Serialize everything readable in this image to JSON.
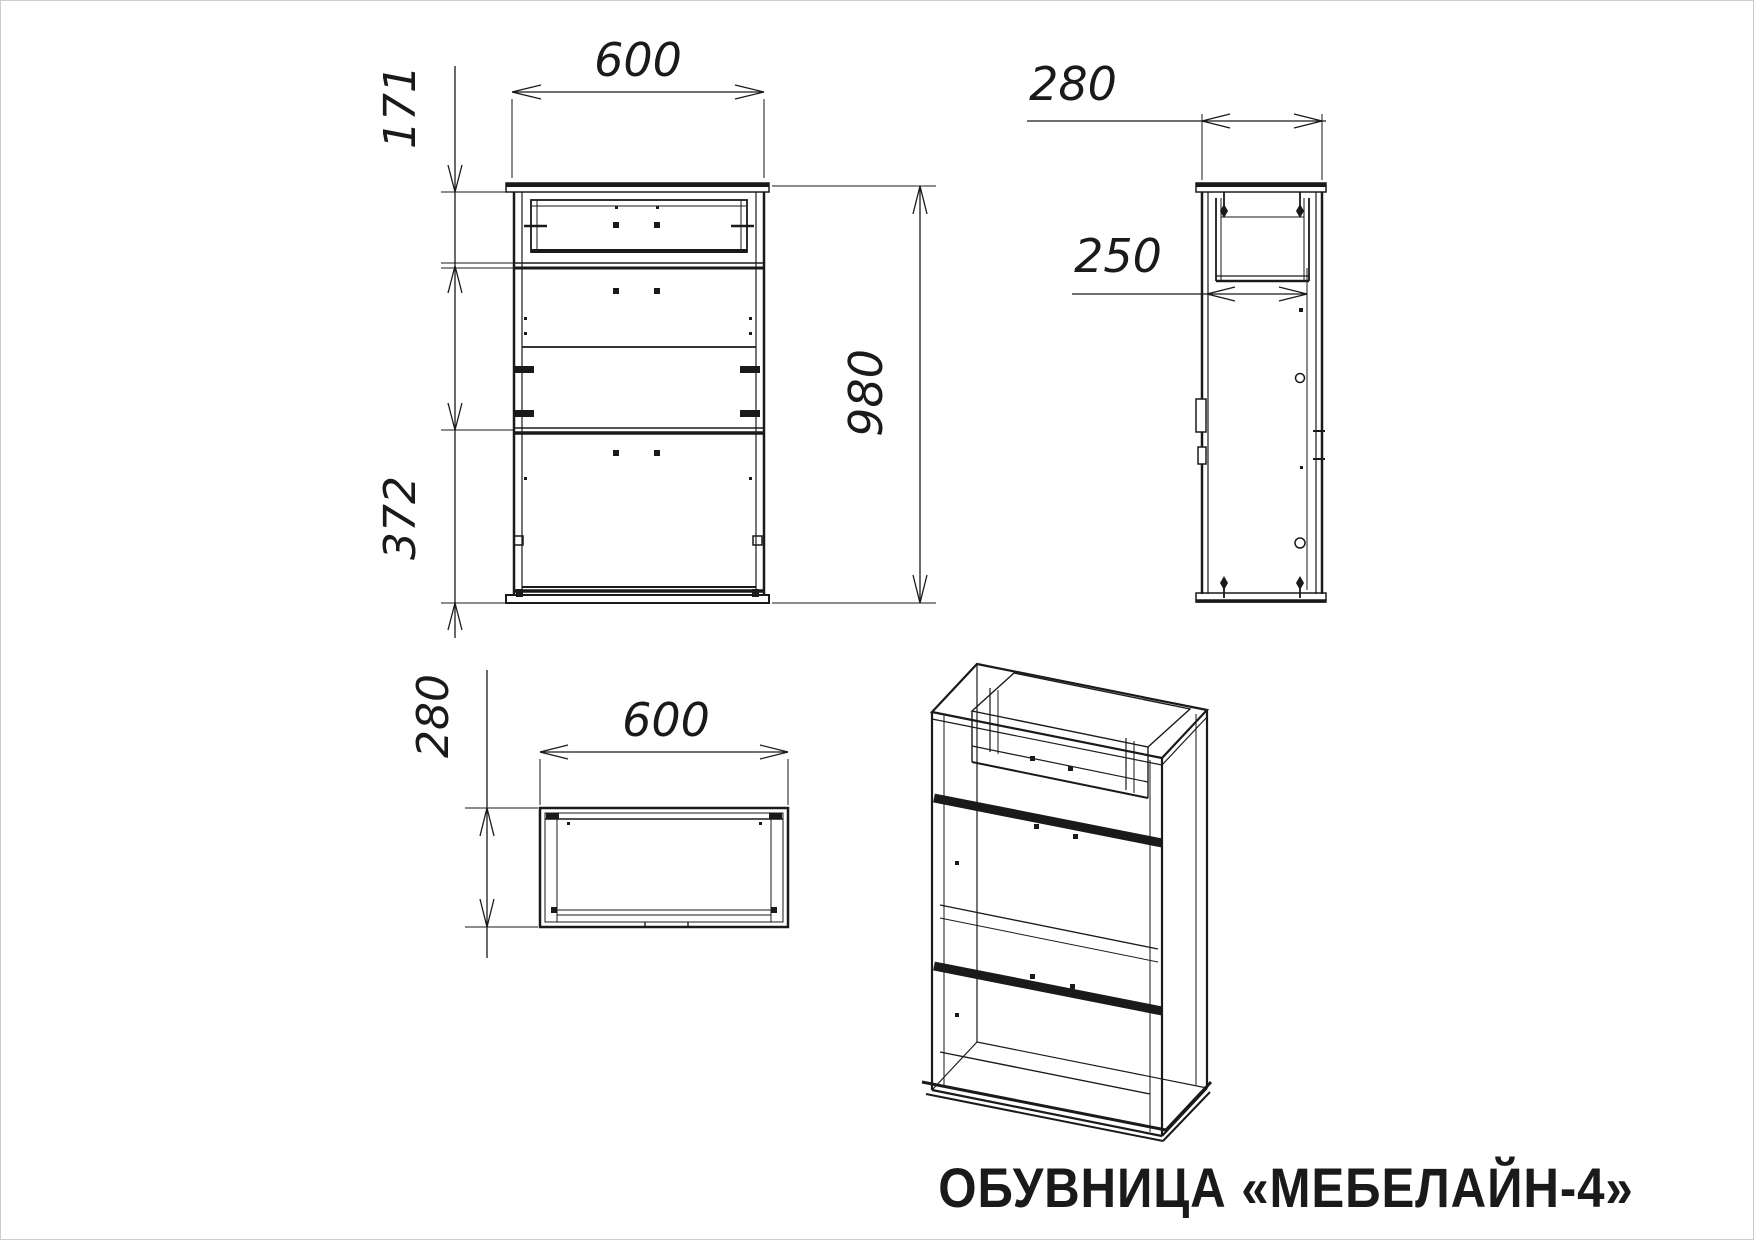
{
  "drawing": {
    "background_color": "#ffffff",
    "line_color": "#1a1a1a",
    "border_color": "#cccccc",
    "caption": "ОБУВНИЦА «МЕБЕЛАЙН-4»",
    "views": {
      "front": {
        "width_mm": "600",
        "top_section_mm": "171",
        "bottom_section_mm": "372",
        "height_mm": "980"
      },
      "side": {
        "depth_mm": "280",
        "shelf_depth_mm": "250"
      },
      "top": {
        "width_mm": "600",
        "depth_mm": "280"
      }
    }
  }
}
